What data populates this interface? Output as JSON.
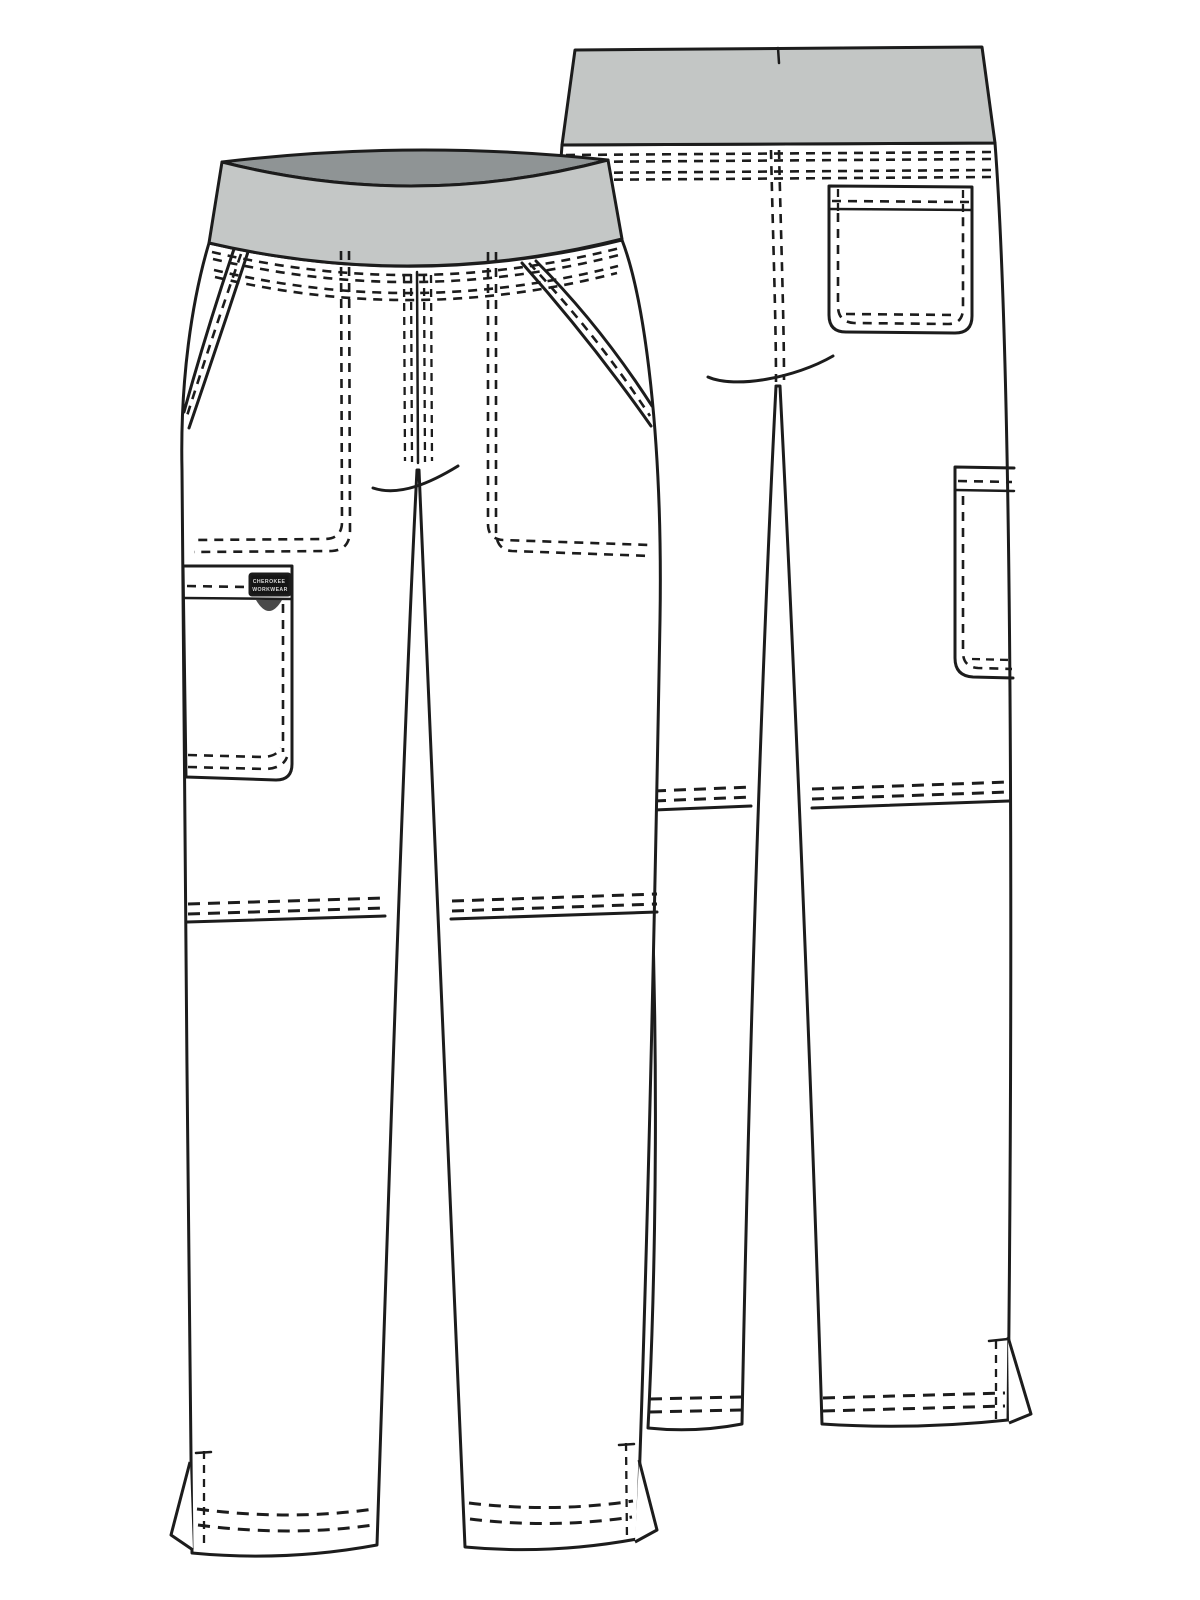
{
  "page": {
    "title": "Technical flat sketch — pull-on cargo scrub pant",
    "description": "Black-and-white garment flat drawing of a scrub pant shown in two overlapping views: front view at left and back view at upper right. Gray knit elastic waistband, angled front slash pockets with stitched pocket bags, left-leg cargo pocket with black brand tab and grommet, back patch pocket, back side cargo pocket, seamed knees, and hem side vents."
  },
  "views": {
    "front": {
      "label": "Front view"
    },
    "back": {
      "label": "Back view"
    }
  },
  "brand_label": {
    "line1": "CHEROKEE",
    "line2": "WORKWEAR"
  },
  "colors": {
    "background": "#ffffff",
    "garment": "#ffffff",
    "line": "#1c1c1c",
    "waistband_front": "#c4c7c6",
    "waistband_top": "#8f9495",
    "waistband_back": "#c3c6c5",
    "label_bg": "#151515",
    "label_text": "#d8d8d8",
    "grommet": "#4a4a4a"
  }
}
